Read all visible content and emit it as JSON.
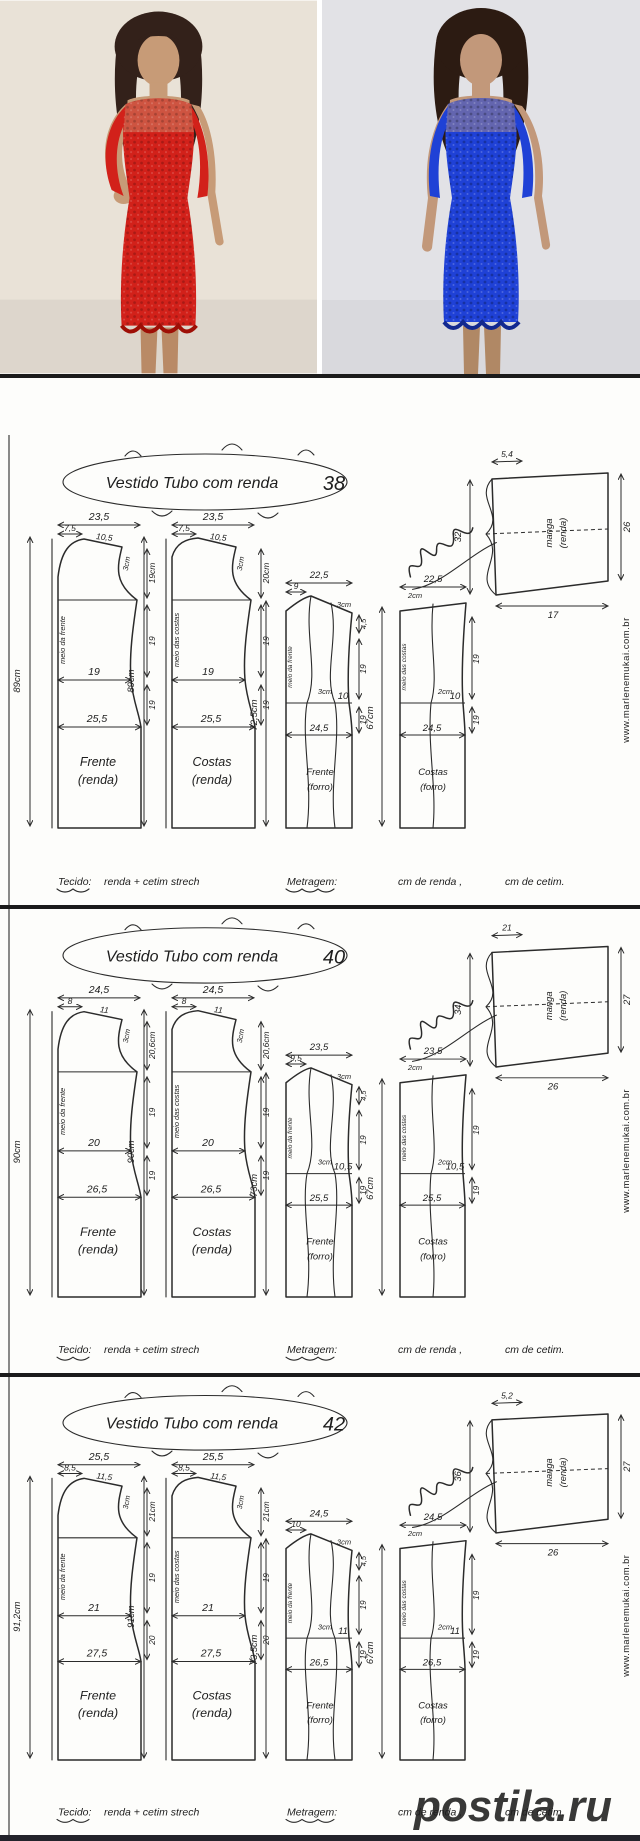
{
  "site_url": "www.marlenemukai.com.br",
  "watermark": {
    "text": "postila.ru",
    "color": "#dd5a5a"
  },
  "photos": {
    "left": {
      "label": "red-lace-dress-model",
      "dress": "#d2211a",
      "dress_dark": "#9e0f06",
      "bg": "#e9e2d7",
      "skin": "#c79b77",
      "skin_dark": "#b98a66",
      "hair": "#33211a"
    },
    "right": {
      "label": "blue-lace-dress-model",
      "dress": "#1f41d6",
      "dress_dark": "#12288f",
      "bg": "#e2e2e6",
      "skin": "#c2987a",
      "skin_dark": "#b08865",
      "hair": "#2c1b12"
    }
  },
  "footer": {
    "tecido_label": "Tecido:",
    "tecido_value": "renda + cetim strech",
    "metragem_label": "Metragem:",
    "renda_fill": "cm de renda ,",
    "cetim_fill": "cm de cetim."
  },
  "sections": [
    {
      "title": "Vestido Tubo com renda",
      "size": "38",
      "front_lace": {
        "name": "Frente",
        "type": "(renda)",
        "fold": "meio da frente",
        "width": "23,5",
        "shoulder": "7,5",
        "slope": "10,5",
        "drop": "3cm",
        "armhole_depth": "19cm",
        "side_upper": "19",
        "side_lower": "19",
        "waist": "19",
        "hip": "25,5",
        "height": "89cm"
      },
      "back_lace": {
        "name": "Costas",
        "type": "(renda)",
        "fold": "meio das costas",
        "width": "23,5",
        "shoulder": "7,5",
        "slope": "10,5",
        "drop": "3cm",
        "armhole_depth": "20cm",
        "side_upper": "19",
        "side_lower": "19",
        "waist": "19",
        "hip": "25,5",
        "height": "89cm"
      },
      "front_lining": {
        "name": "Frente",
        "type": "(forro)",
        "fold": "meio da frente",
        "width": "22,5",
        "neck": "9",
        "drop": "3cm",
        "dart": "3cm",
        "waist": "10",
        "hip": "24,5",
        "height": "72,5cm",
        "side_top": "4,5",
        "side_upper": "19",
        "side_lower": "19"
      },
      "back_lining": {
        "name": "Costas",
        "type": "(forro)",
        "fold": "meio das costas",
        "width": "22,5",
        "notch": "2cm",
        "dart": "2cm",
        "waist": "10",
        "hip": "24,5",
        "height": "67cm",
        "side_upper": "19",
        "side_lower": "19"
      },
      "sleeve": {
        "name": "manga",
        "type": "(renda)",
        "top": "5,4",
        "cap": "32",
        "hem": "26",
        "length": "17"
      }
    },
    {
      "title": "Vestido Tubo com renda",
      "size": "40",
      "front_lace": {
        "name": "Frente",
        "type": "(renda)",
        "fold": "meio da frente",
        "width": "24,5",
        "shoulder": "8",
        "slope": "11",
        "drop": "3cm",
        "armhole_depth": "20,6cm",
        "side_upper": "19",
        "side_lower": "19",
        "waist": "20",
        "hip": "26,5",
        "height": "90cm"
      },
      "back_lace": {
        "name": "Costas",
        "type": "(renda)",
        "fold": "meio das costas",
        "width": "24,5",
        "shoulder": "8",
        "slope": "11",
        "drop": "3cm",
        "armhole_depth": "20,6cm",
        "side_upper": "19",
        "side_lower": "19",
        "waist": "20",
        "hip": "26,5",
        "height": "90cm"
      },
      "front_lining": {
        "name": "Frente",
        "type": "(forro)",
        "fold": "meio da frente",
        "width": "23,5",
        "neck": "9,5",
        "drop": "3cm",
        "dart": "3cm",
        "waist": "10,5",
        "hip": "25,5",
        "height": "73cm",
        "side_top": "4,5",
        "side_upper": "19",
        "side_lower": "19"
      },
      "back_lining": {
        "name": "Costas",
        "type": "(forro)",
        "fold": "meio das costas",
        "width": "23,5",
        "notch": "2cm",
        "dart": "2cm",
        "waist": "10,5",
        "hip": "25,5",
        "height": "67cm",
        "side_upper": "19",
        "side_lower": "19"
      },
      "sleeve": {
        "name": "manga",
        "type": "(renda)",
        "top": "21",
        "cap": "34",
        "hem": "27",
        "length": "26"
      }
    },
    {
      "title": "Vestido Tubo com renda",
      "size": "42",
      "front_lace": {
        "name": "Frente",
        "type": "(renda)",
        "fold": "meio da frente",
        "width": "25,5",
        "shoulder": "8,5",
        "slope": "11,5",
        "drop": "3cm",
        "armhole_depth": "21cm",
        "side_upper": "19",
        "side_lower": "20",
        "waist": "21",
        "hip": "27,5",
        "height": "91,2cm"
      },
      "back_lace": {
        "name": "Costas",
        "type": "(renda)",
        "fold": "meio das costas",
        "width": "25,5",
        "shoulder": "8,5",
        "slope": "11,5",
        "drop": "3cm",
        "armhole_depth": "21cm",
        "side_upper": "19",
        "side_lower": "20",
        "waist": "21",
        "hip": "27,5",
        "height": "91cm"
      },
      "front_lining": {
        "name": "Frente",
        "type": "(forro)",
        "fold": "meio da frente",
        "width": "24,5",
        "neck": "10",
        "drop": "3cm",
        "dart": "3cm",
        "waist": "11",
        "hip": "26,5",
        "height": "73,5cm",
        "side_top": "4,5",
        "side_upper": "19",
        "side_lower": "19"
      },
      "back_lining": {
        "name": "Costas",
        "type": "(forro)",
        "fold": "meio das costas",
        "width": "24,5",
        "notch": "2cm",
        "dart": "2cm",
        "waist": "11",
        "hip": "26,5",
        "height": "67cm",
        "side_upper": "19",
        "side_lower": "19"
      },
      "sleeve": {
        "name": "manga",
        "type": "(renda)",
        "top": "5,2",
        "cap": "36",
        "hem": "27",
        "length": "26"
      }
    }
  ]
}
